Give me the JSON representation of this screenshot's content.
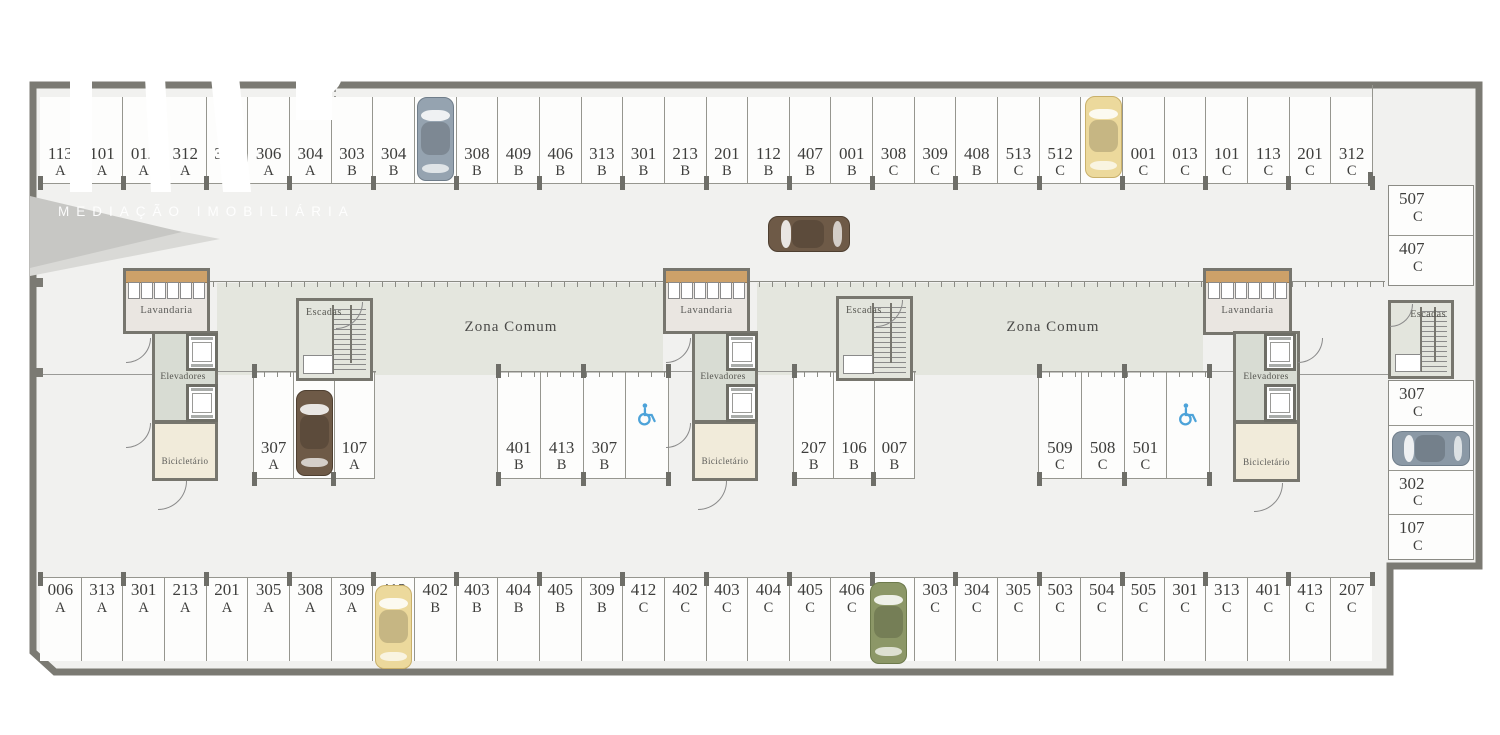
{
  "watermark": {
    "subtitle": "MEDIAÇÃO IMOBILIÁRIA"
  },
  "room_labels": {
    "zona_comum": "Zona Comum",
    "lavandaria": "Lavandaria",
    "elevadores": "Elevadores",
    "bicicletario": "Bicicletário",
    "escadas": "Escadas"
  },
  "parking": {
    "top_row": [
      {
        "num": "113",
        "block": "A"
      },
      {
        "num": "101",
        "block": "A"
      },
      {
        "num": "012",
        "block": "A"
      },
      {
        "num": "312",
        "block": "A"
      },
      {
        "num": "302",
        "block": "A"
      },
      {
        "num": "306",
        "block": "A"
      },
      {
        "num": "304",
        "block": "A"
      },
      {
        "num": "303",
        "block": "B"
      },
      {
        "num": "304",
        "block": "B"
      },
      {
        "num": "305",
        "block": "B"
      },
      {
        "num": "308",
        "block": "B"
      },
      {
        "num": "409",
        "block": "B"
      },
      {
        "num": "406",
        "block": "B"
      },
      {
        "num": "313",
        "block": "B"
      },
      {
        "num": "301",
        "block": "B"
      },
      {
        "num": "213",
        "block": "B"
      },
      {
        "num": "201",
        "block": "B"
      },
      {
        "num": "112",
        "block": "B"
      },
      {
        "num": "407",
        "block": "B"
      },
      {
        "num": "001",
        "block": "B"
      },
      {
        "num": "308",
        "block": "C"
      },
      {
        "num": "309",
        "block": "C"
      },
      {
        "num": "408",
        "block": "B"
      },
      {
        "num": "513",
        "block": "C"
      },
      {
        "num": "512",
        "block": "C"
      },
      {
        "num": "502",
        "block": "C"
      },
      {
        "num": "001",
        "block": "C"
      },
      {
        "num": "013",
        "block": "C"
      },
      {
        "num": "101",
        "block": "C"
      },
      {
        "num": "113",
        "block": "C"
      },
      {
        "num": "201",
        "block": "C"
      },
      {
        "num": "312",
        "block": "C"
      }
    ],
    "bottom_row": [
      {
        "num": "006",
        "block": "A"
      },
      {
        "num": "313",
        "block": "A"
      },
      {
        "num": "301",
        "block": "A"
      },
      {
        "num": "213",
        "block": "A"
      },
      {
        "num": "201",
        "block": "A"
      },
      {
        "num": "305",
        "block": "A"
      },
      {
        "num": "308",
        "block": "A"
      },
      {
        "num": "309",
        "block": "A"
      },
      {
        "num": "412",
        "block": "B"
      },
      {
        "num": "402",
        "block": "B"
      },
      {
        "num": "403",
        "block": "B"
      },
      {
        "num": "404",
        "block": "B"
      },
      {
        "num": "405",
        "block": "B"
      },
      {
        "num": "309",
        "block": "B"
      },
      {
        "num": "412",
        "block": "C"
      },
      {
        "num": "402",
        "block": "C"
      },
      {
        "num": "403",
        "block": "C"
      },
      {
        "num": "404",
        "block": "C"
      },
      {
        "num": "405",
        "block": "C"
      },
      {
        "num": "406",
        "block": "C"
      },
      {
        "num": "409",
        "block": "C"
      },
      {
        "num": "303",
        "block": "C"
      },
      {
        "num": "304",
        "block": "C"
      },
      {
        "num": "305",
        "block": "C"
      },
      {
        "num": "503",
        "block": "C"
      },
      {
        "num": "504",
        "block": "C"
      },
      {
        "num": "505",
        "block": "C"
      },
      {
        "num": "301",
        "block": "C"
      },
      {
        "num": "313",
        "block": "C"
      },
      {
        "num": "401",
        "block": "C"
      },
      {
        "num": "413",
        "block": "C"
      },
      {
        "num": "207",
        "block": "C"
      }
    ],
    "right_column_upper": [
      {
        "num": "507",
        "block": "C"
      },
      {
        "num": "407",
        "block": "C"
      }
    ],
    "right_column_lower": [
      {
        "num": "307",
        "block": "C"
      },
      {
        "num": "007",
        "block": "C"
      },
      {
        "num": "302",
        "block": "C"
      },
      {
        "num": "107",
        "block": "C"
      }
    ],
    "clusters": [
      {
        "spots": [
          {
            "num": "307",
            "block": "A"
          },
          {
            "num": "207",
            "block": "A"
          },
          {
            "num": "107",
            "block": "A"
          }
        ]
      },
      {
        "spots": [
          {
            "num": "401",
            "block": "B"
          },
          {
            "num": "413",
            "block": "B"
          },
          {
            "num": "307",
            "block": "B"
          },
          {
            "accessible": true
          }
        ]
      },
      {
        "spots": [
          {
            "num": "207",
            "block": "B"
          },
          {
            "num": "106",
            "block": "B"
          },
          {
            "num": "007",
            "block": "B"
          }
        ]
      },
      {
        "spots": [
          {
            "num": "509",
            "block": "C"
          },
          {
            "num": "508",
            "block": "C"
          },
          {
            "num": "501",
            "block": "C"
          },
          {
            "accessible": true
          }
        ]
      }
    ]
  },
  "cars": [
    {
      "location": "spot 305 B",
      "color": "#95a3b0",
      "trim": "#6f7d8a",
      "x": 417,
      "y": 97,
      "w": 37,
      "h": 84,
      "dir": "v"
    },
    {
      "location": "spot 502 C",
      "color": "#ecd99c",
      "trim": "#c9b06a",
      "x": 1085,
      "y": 96,
      "w": 37,
      "h": 82,
      "dir": "v"
    },
    {
      "location": "aisle",
      "color": "#6e5a47",
      "trim": "#4e3f30",
      "x": 768,
      "y": 216,
      "w": 82,
      "h": 36,
      "dir": "h"
    },
    {
      "location": "spot 207 A",
      "color": "#6e5a47",
      "trim": "#4e3f30",
      "x": 296,
      "y": 390,
      "w": 37,
      "h": 86,
      "dir": "v"
    },
    {
      "location": "spot 412 B",
      "color": "#ecd99c",
      "trim": "#c9b06a",
      "x": 375,
      "y": 585,
      "w": 37,
      "h": 84,
      "dir": "v"
    },
    {
      "location": "spot 409 C",
      "color": "#8c9767",
      "trim": "#6d7a4c",
      "x": 870,
      "y": 582,
      "w": 37,
      "h": 82,
      "dir": "v"
    },
    {
      "location": "spot 007 C",
      "color": "#8b99a6",
      "trim": "#6f7d8a",
      "x": 1392,
      "y": 431,
      "w": 78,
      "h": 35,
      "dir": "h"
    }
  ],
  "accessibility": {
    "icon": "wheelchair",
    "color": "#4da3d9",
    "count": 2
  },
  "colors": {
    "wall": "#7b7a73",
    "floor": "#f1f1ef",
    "zona_comum_tint": "#e4e6de",
    "lavandaria_fill": "#eae6e1",
    "laundry_counter": "#cda169",
    "corridor_fill": "#d8dcd3",
    "bicicletario_fill": "#f1ebda",
    "stairs_fill": "#e3e5dd",
    "label_text": "#3e3e3c",
    "car_gray_blue": "#95a3b0",
    "car_yellow": "#ecd99c",
    "car_brown": "#6e5a47",
    "car_green": "#8c9767"
  }
}
